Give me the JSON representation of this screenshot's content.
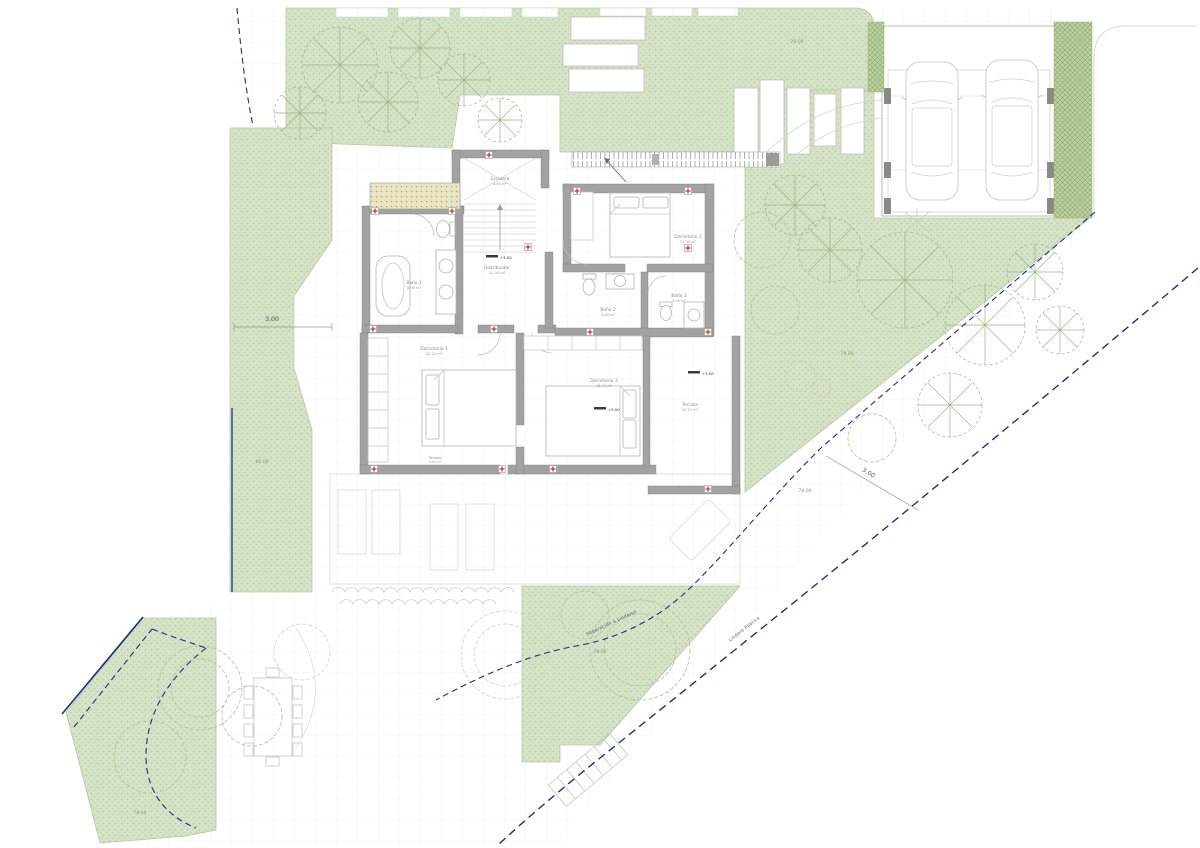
{
  "plan": {
    "rooms": {
      "escalera": {
        "name": "Escalera",
        "area": "4,80 m²"
      },
      "bano1": {
        "name": "Baño 1",
        "area": "8,90 m²"
      },
      "distribuidor": {
        "name": "Distribuidor",
        "area": "11,30 m²"
      },
      "dormitorio2": {
        "name": "Dormitorio 2",
        "area": "11,50 m²"
      },
      "bano2": {
        "name": "Baño 2",
        "area": "5,40 m²"
      },
      "bano3": {
        "name": "Baño 3",
        "area": "3,90 m²"
      },
      "dormitorio1": {
        "name": "Dormitorio 1",
        "area": "20,20 m²"
      },
      "dormitorio3": {
        "name": "Dormitorio 3",
        "area": "16,70 m²"
      },
      "terraza": {
        "name": "Terraza",
        "area": "20,10 m²"
      },
      "terraza_inferior": {
        "name": "Terraza",
        "area": "5,67 m²"
      }
    },
    "levels": {
      "main": "+3.00"
    },
    "dimensions": {
      "left_offset": "3,00",
      "setback_offset": "3.00",
      "contour_80": "80.00",
      "contour_79_top": "79.00",
      "contour_79_right": "79.00",
      "contour_78_right": "78.00",
      "contour_78_center": "78.00",
      "contour_78_bottom": "78.00"
    },
    "boundaries": {
      "separacion": "Separación a Linderos",
      "lindero": "Lindero Público"
    },
    "colors": {
      "green_fill": "#d7e3c8",
      "green_dark": "#bdd0a0",
      "wall_gray": "#a2a2a2",
      "boundary_blue": "#1e2f7d",
      "marker_red": "#cc3333",
      "contour_text": "#8a9a6a"
    }
  }
}
